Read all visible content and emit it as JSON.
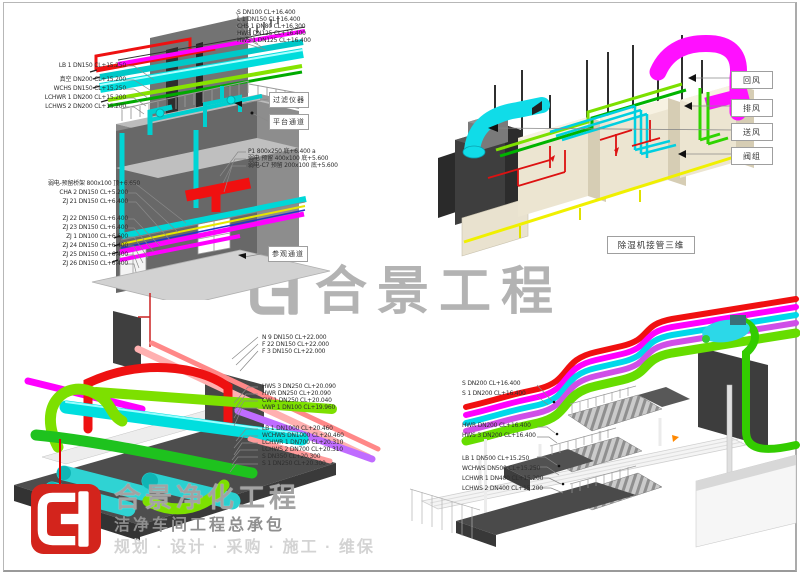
{
  "watermark": {
    "text": "合景工程"
  },
  "footer_logo": {
    "title": "合景净化工程",
    "subtitle": "洁净车间工程总承包",
    "services": "规划 · 设计 · 采购 · 施工 · 维保"
  },
  "colors": {
    "brand_red": "#d3241c",
    "watermark_gray": "#b3b3b3"
  },
  "q1": {
    "top_right_labels": [
      "S DN100 CL+16.400",
      "L 1 DN150 CL+16.400",
      "CHS 1 DN80 CL+16.300",
      "HWR DN125 CL+16.400",
      "HWS 1 DN125 CL+16.400"
    ],
    "top_left_labels": [
      "LB 1 DN150 CL+15.250",
      "真空 DN200 CL+15.200",
      "WCHS DN150 CL+15.250",
      "LCHWR 1 DN200 CL+15.200",
      "LCHWS 2 DN200 CL+15.200"
    ],
    "mid_right_labels": [
      "P1 800x250 底+6.400 a",
      "弱电 预留 400x100 底+5.600",
      "弱电-C7 预留 200x100 底+5.600"
    ],
    "bottom_left_labels": [
      "弱电-预留桥架 800x100 顶+6.650",
      "CHA 2 DN150 CL+5.200",
      "ZJ 21 DN150 CL+6.400",
      "ZJ 22 DN150 CL+6.400",
      "ZJ 23 DN150 CL+6.400",
      "ZJ 1 DN100 CL+6.600",
      "ZJ 24 DN150 CL+6.400",
      "ZJ 25 DN150 CL+6.400",
      "ZJ 26 DN150 CL+6.400"
    ],
    "boxes": [
      "过滤仪器",
      "平台通道",
      "参观通道"
    ]
  },
  "q2": {
    "boxes": [
      "回风",
      "排风",
      "送风",
      "阀组"
    ],
    "caption": "除湿机接管三维"
  },
  "q3": {
    "labels_a": [
      "N 9 DN150 CL+22.000",
      "F 22 DN150 CL+22.000",
      "F 3 DN150 CL+22.000"
    ],
    "labels_b": [
      "HWS 3 DN250 CL+20.090",
      "HWR DN250 CL+20.090",
      "CW 1 DN250 CL+20.040",
      "VWP 1 DN100 CL+19.960"
    ],
    "labels_c": [
      "LB 1 DN1000 CL+20.460",
      "WCHWS DN1000 CL+20.460",
      "LCHWR 1 DN700 CL+20.310",
      "LCHWS 2 DN700 CL+20.310",
      "S DN350 CL+20.300",
      "S 1 DN250 CL+20.300"
    ]
  },
  "q4": {
    "labels_a": [
      "S DN200 CL+16.400",
      "S 1 DN200 CL+16.400"
    ],
    "labels_b": [
      "HWR DN200 CL+16.400",
      "HWS 3 DN200 CL+16.400"
    ],
    "labels_c": [
      "LB 1 DN500 CL+15.250",
      "WCHWS DN500 CL+15.250",
      "LCHWR 1 DN400 CL+15.200",
      "LCHWS 2 DN400 CL+15.200"
    ]
  }
}
